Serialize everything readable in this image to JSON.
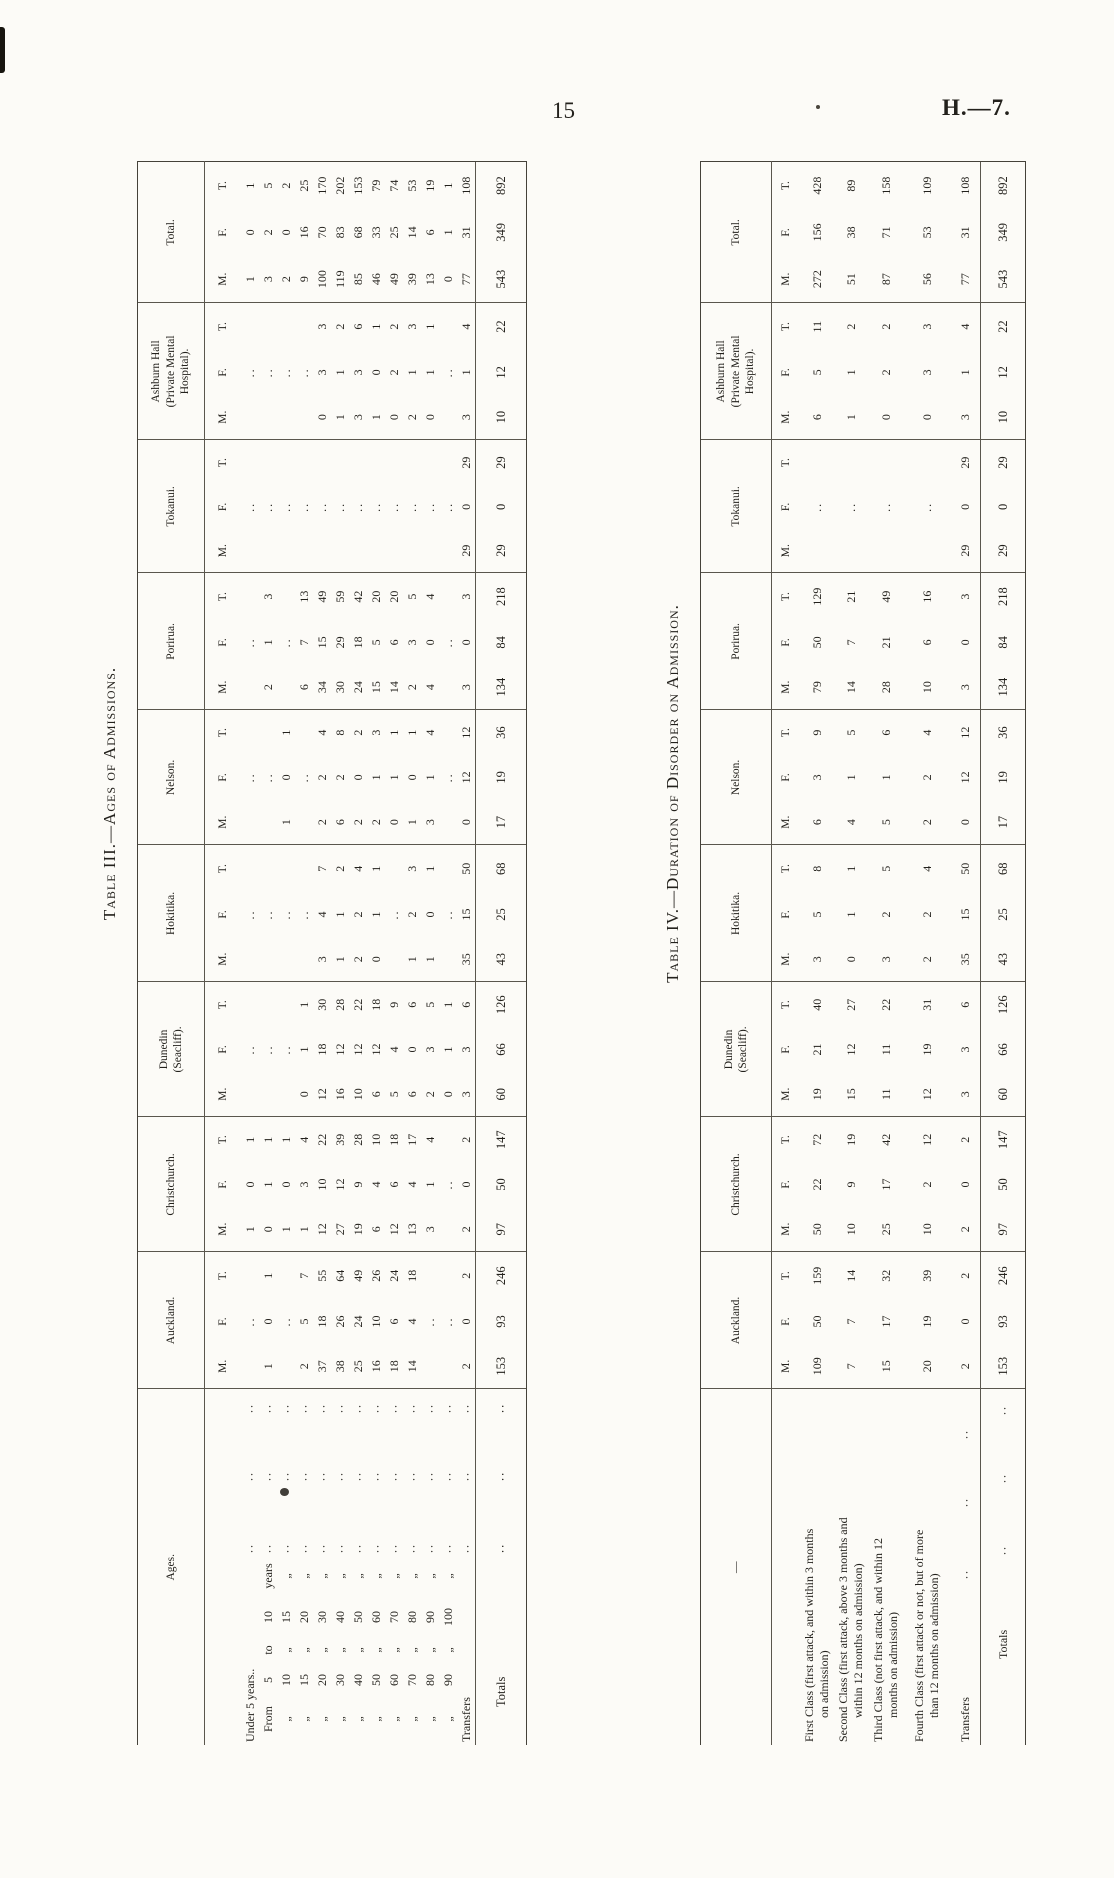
{
  "page": {
    "number": "15",
    "reference": "H.—7."
  },
  "table3": {
    "title": "Table III.—Ages of Admissions.",
    "corner_label": "Ages.",
    "col_headers": [
      [
        "Auckland."
      ],
      [
        "Christchurch."
      ],
      [
        "Dunedin",
        "(Seacliff)."
      ],
      [
        "Hokitika."
      ],
      [
        "Nelson."
      ],
      [
        "Porirua."
      ],
      [
        "Tokanui."
      ],
      [
        "Ashburn Hall",
        "(Private Mental",
        "Hospital)."
      ],
      [
        "Total."
      ]
    ],
    "sub_headers": [
      "M.",
      "F.",
      "T."
    ],
    "leader": "..",
    "rows": [
      {
        "label": {
          "text": "Under 5 years.."
        },
        "dots": true,
        "cells": [
          [
            "",
            "..",
            ""
          ],
          [
            "1",
            "0",
            "1"
          ],
          [
            "",
            "..",
            ""
          ],
          [
            "",
            "..",
            ""
          ],
          [
            "",
            "..",
            ""
          ],
          [
            "",
            "..",
            ""
          ],
          [
            "",
            "..",
            ""
          ],
          [
            "",
            "..",
            ""
          ],
          [
            "1",
            "0",
            "1"
          ]
        ]
      },
      {
        "label": {
          "parts": [
            "From",
            "5",
            "to",
            "10",
            "years"
          ]
        },
        "dots": true,
        "cells": [
          [
            "1",
            "0",
            "1"
          ],
          [
            "0",
            "1",
            "1"
          ],
          [
            "",
            "..",
            ""
          ],
          [
            "",
            "..",
            ""
          ],
          [
            "",
            "..",
            ""
          ],
          [
            "2",
            "1",
            "3"
          ],
          [
            "",
            "..",
            ""
          ],
          [
            "",
            "..",
            ""
          ],
          [
            "3",
            "2",
            "5"
          ]
        ]
      },
      {
        "label": {
          "parts": [
            "„",
            "10",
            "„",
            "15",
            "„"
          ]
        },
        "dots": true,
        "cells": [
          [
            "",
            "..",
            ""
          ],
          [
            "1",
            "0",
            "1"
          ],
          [
            "",
            "..",
            ""
          ],
          [
            "",
            "..",
            ""
          ],
          [
            "1",
            "0",
            "1"
          ],
          [
            "",
            "..",
            ""
          ],
          [
            "",
            "..",
            ""
          ],
          [
            "",
            "..",
            ""
          ],
          [
            "2",
            "0",
            "2"
          ]
        ]
      },
      {
        "label": {
          "parts": [
            "„",
            "15",
            "„",
            "20",
            "„"
          ]
        },
        "dots": true,
        "cells": [
          [
            "2",
            "5",
            "7"
          ],
          [
            "1",
            "3",
            "4"
          ],
          [
            "0",
            "1",
            "1"
          ],
          [
            "",
            "..",
            ""
          ],
          [
            "",
            "..",
            ""
          ],
          [
            "6",
            "7",
            "13"
          ],
          [
            "",
            "..",
            ""
          ],
          [
            "",
            "..",
            ""
          ],
          [
            "9",
            "16",
            "25"
          ]
        ]
      },
      {
        "label": {
          "parts": [
            "„",
            "20",
            "„",
            "30",
            "„"
          ]
        },
        "dots": true,
        "cells": [
          [
            "37",
            "18",
            "55"
          ],
          [
            "12",
            "10",
            "22"
          ],
          [
            "12",
            "18",
            "30"
          ],
          [
            "3",
            "4",
            "7"
          ],
          [
            "2",
            "2",
            "4"
          ],
          [
            "34",
            "15",
            "49"
          ],
          [
            "",
            "..",
            ""
          ],
          [
            "0",
            "3",
            "3"
          ],
          [
            "100",
            "70",
            "170"
          ]
        ]
      },
      {
        "label": {
          "parts": [
            "„",
            "30",
            "„",
            "40",
            "„"
          ]
        },
        "dots": true,
        "cells": [
          [
            "38",
            "26",
            "64"
          ],
          [
            "27",
            "12",
            "39"
          ],
          [
            "16",
            "12",
            "28"
          ],
          [
            "1",
            "1",
            "2"
          ],
          [
            "6",
            "2",
            "8"
          ],
          [
            "30",
            "29",
            "59"
          ],
          [
            "",
            "..",
            ""
          ],
          [
            "1",
            "1",
            "2"
          ],
          [
            "119",
            "83",
            "202"
          ]
        ]
      },
      {
        "label": {
          "parts": [
            "„",
            "40",
            "„",
            "50",
            "„"
          ]
        },
        "dots": true,
        "cells": [
          [
            "25",
            "24",
            "49"
          ],
          [
            "19",
            "9",
            "28"
          ],
          [
            "10",
            "12",
            "22"
          ],
          [
            "2",
            "2",
            "4"
          ],
          [
            "2",
            "0",
            "2"
          ],
          [
            "24",
            "18",
            "42"
          ],
          [
            "",
            "..",
            ""
          ],
          [
            "3",
            "3",
            "6"
          ],
          [
            "85",
            "68",
            "153"
          ]
        ]
      },
      {
        "label": {
          "parts": [
            "„",
            "50",
            "„",
            "60",
            "„"
          ]
        },
        "dots": true,
        "cells": [
          [
            "16",
            "10",
            "26"
          ],
          [
            "6",
            "4",
            "10"
          ],
          [
            "6",
            "12",
            "18"
          ],
          [
            "0",
            "1",
            "1"
          ],
          [
            "2",
            "1",
            "3"
          ],
          [
            "15",
            "5",
            "20"
          ],
          [
            "",
            "..",
            ""
          ],
          [
            "1",
            "0",
            "1"
          ],
          [
            "46",
            "33",
            "79"
          ]
        ]
      },
      {
        "label": {
          "parts": [
            "„",
            "60",
            "„",
            "70",
            "„"
          ]
        },
        "dots": true,
        "cells": [
          [
            "18",
            "6",
            "24"
          ],
          [
            "12",
            "6",
            "18"
          ],
          [
            "5",
            "4",
            "9"
          ],
          [
            "",
            "..",
            ""
          ],
          [
            "0",
            "1",
            "1"
          ],
          [
            "14",
            "6",
            "20"
          ],
          [
            "",
            "..",
            ""
          ],
          [
            "0",
            "2",
            "2"
          ],
          [
            "49",
            "25",
            "74"
          ]
        ]
      },
      {
        "label": {
          "parts": [
            "„",
            "70",
            "„",
            "80",
            "„"
          ]
        },
        "dots": true,
        "cells": [
          [
            "14",
            "4",
            "18"
          ],
          [
            "13",
            "4",
            "17"
          ],
          [
            "6",
            "0",
            "6"
          ],
          [
            "1",
            "2",
            "3"
          ],
          [
            "1",
            "0",
            "1"
          ],
          [
            "2",
            "3",
            "5"
          ],
          [
            "",
            "..",
            ""
          ],
          [
            "2",
            "1",
            "3"
          ],
          [
            "39",
            "14",
            "53"
          ]
        ]
      },
      {
        "label": {
          "parts": [
            "„",
            "80",
            "„",
            "90",
            "„"
          ]
        },
        "dots": true,
        "cells": [
          [
            "",
            "..",
            ""
          ],
          [
            "3",
            "1",
            "4"
          ],
          [
            "2",
            "3",
            "5"
          ],
          [
            "1",
            "0",
            "1"
          ],
          [
            "3",
            "1",
            "4"
          ],
          [
            "4",
            "0",
            "4"
          ],
          [
            "",
            "..",
            ""
          ],
          [
            "0",
            "1",
            "1"
          ],
          [
            "13",
            "6",
            "19"
          ]
        ]
      },
      {
        "label": {
          "parts": [
            "„",
            "90",
            "„",
            "100",
            "„"
          ]
        },
        "dots": true,
        "cells": [
          [
            "",
            "..",
            ""
          ],
          [
            "",
            "..",
            ""
          ],
          [
            "0",
            "1",
            "1"
          ],
          [
            "",
            "..",
            ""
          ],
          [
            "",
            "..",
            ""
          ],
          [
            "",
            "..",
            ""
          ],
          [
            "",
            "..",
            ""
          ],
          [
            "",
            "..",
            ""
          ],
          [
            "0",
            "1",
            "1"
          ]
        ]
      },
      {
        "label": {
          "text": "Transfers"
        },
        "dots": true,
        "cells": [
          [
            "2",
            "0",
            "2"
          ],
          [
            "2",
            "0",
            "2"
          ],
          [
            "3",
            "3",
            "6"
          ],
          [
            "35",
            "15",
            "50"
          ],
          [
            "0",
            "12",
            "12"
          ],
          [
            "3",
            "0",
            "3"
          ],
          [
            "29",
            "0",
            "29"
          ],
          [
            "3",
            "1",
            "4"
          ],
          [
            "77",
            "31",
            "108"
          ]
        ]
      }
    ],
    "totals": {
      "label": {
        "text": "Totals"
      },
      "dots": true,
      "cells": [
        [
          "153",
          "93",
          "246"
        ],
        [
          "97",
          "50",
          "147"
        ],
        [
          "60",
          "66",
          "126"
        ],
        [
          "43",
          "25",
          "68"
        ],
        [
          "17",
          "19",
          "36"
        ],
        [
          "134",
          "84",
          "218"
        ],
        [
          "29",
          "0",
          "29"
        ],
        [
          "10",
          "12",
          "22"
        ],
        [
          "543",
          "349",
          "892"
        ]
      ]
    }
  },
  "table4": {
    "title": "Table IV.—Duration of Disorder on Admission.",
    "corner_label": "—",
    "col_headers": [
      [
        "Auckland."
      ],
      [
        "Christchurch."
      ],
      [
        "Dunedin",
        "(Seacliff)."
      ],
      [
        "Hokitika."
      ],
      [
        "Nelson."
      ],
      [
        "Porirua."
      ],
      [
        "Tokanui."
      ],
      [
        "Ashburn Hall",
        "(Private Mental",
        "Hospital)."
      ],
      [
        "Total."
      ]
    ],
    "sub_headers": [
      "M.",
      "F.",
      "T."
    ],
    "leader": "..",
    "rows": [
      {
        "label": {
          "lines": [
            "First Class (first attack, and within 3 months",
            "on admission)"
          ]
        },
        "dots": false,
        "cells": [
          [
            "109",
            "50",
            "159"
          ],
          [
            "50",
            "22",
            "72"
          ],
          [
            "19",
            "21",
            "40"
          ],
          [
            "3",
            "5",
            "8"
          ],
          [
            "6",
            "3",
            "9"
          ],
          [
            "79",
            "50",
            "129"
          ],
          [
            "",
            "..",
            ""
          ],
          [
            "6",
            "5",
            "11"
          ],
          [
            "272",
            "156",
            "428"
          ]
        ]
      },
      {
        "label": {
          "lines": [
            "Second Class (first attack, above 3 months and",
            "within 12 months on admission)"
          ]
        },
        "dots": false,
        "cells": [
          [
            "7",
            "7",
            "14"
          ],
          [
            "10",
            "9",
            "19"
          ],
          [
            "15",
            "12",
            "27"
          ],
          [
            "0",
            "1",
            "1"
          ],
          [
            "4",
            "1",
            "5"
          ],
          [
            "14",
            "7",
            "21"
          ],
          [
            "",
            "..",
            ""
          ],
          [
            "1",
            "1",
            "2"
          ],
          [
            "51",
            "38",
            "89"
          ]
        ]
      },
      {
        "label": {
          "lines": [
            "Third Class (not first attack, and within 12",
            "months on admission)"
          ]
        },
        "dots": false,
        "cells": [
          [
            "15",
            "17",
            "32"
          ],
          [
            "25",
            "17",
            "42"
          ],
          [
            "11",
            "11",
            "22"
          ],
          [
            "3",
            "2",
            "5"
          ],
          [
            "5",
            "1",
            "6"
          ],
          [
            "28",
            "21",
            "49"
          ],
          [
            "",
            "..",
            ""
          ],
          [
            "0",
            "2",
            "2"
          ],
          [
            "87",
            "71",
            "158"
          ]
        ]
      },
      {
        "label": {
          "lines": [
            "Fourth Class (first attack or not, but of more",
            "than 12 months on admission)"
          ]
        },
        "dots": false,
        "cells": [
          [
            "20",
            "19",
            "39"
          ],
          [
            "10",
            "2",
            "12"
          ],
          [
            "12",
            "19",
            "31"
          ],
          [
            "2",
            "2",
            "4"
          ],
          [
            "2",
            "2",
            "4"
          ],
          [
            "10",
            "6",
            "16"
          ],
          [
            "",
            "..",
            ""
          ],
          [
            "0",
            "3",
            "3"
          ],
          [
            "56",
            "53",
            "109"
          ]
        ]
      },
      {
        "label": {
          "text": "Transfers"
        },
        "dots": true,
        "cells": [
          [
            "2",
            "0",
            "2"
          ],
          [
            "2",
            "0",
            "2"
          ],
          [
            "3",
            "3",
            "6"
          ],
          [
            "35",
            "15",
            "50"
          ],
          [
            "0",
            "12",
            "12"
          ],
          [
            "3",
            "0",
            "3"
          ],
          [
            "29",
            "0",
            "29"
          ],
          [
            "3",
            "1",
            "4"
          ],
          [
            "77",
            "31",
            "108"
          ]
        ]
      }
    ],
    "totals": {
      "label": {
        "text": "Totals"
      },
      "dots": true,
      "cells": [
        [
          "153",
          "93",
          "246"
        ],
        [
          "97",
          "50",
          "147"
        ],
        [
          "60",
          "66",
          "126"
        ],
        [
          "43",
          "25",
          "68"
        ],
        [
          "17",
          "19",
          "36"
        ],
        [
          "134",
          "84",
          "218"
        ],
        [
          "29",
          "0",
          "29"
        ],
        [
          "10",
          "12",
          "22"
        ],
        [
          "543",
          "349",
          "892"
        ]
      ]
    }
  }
}
